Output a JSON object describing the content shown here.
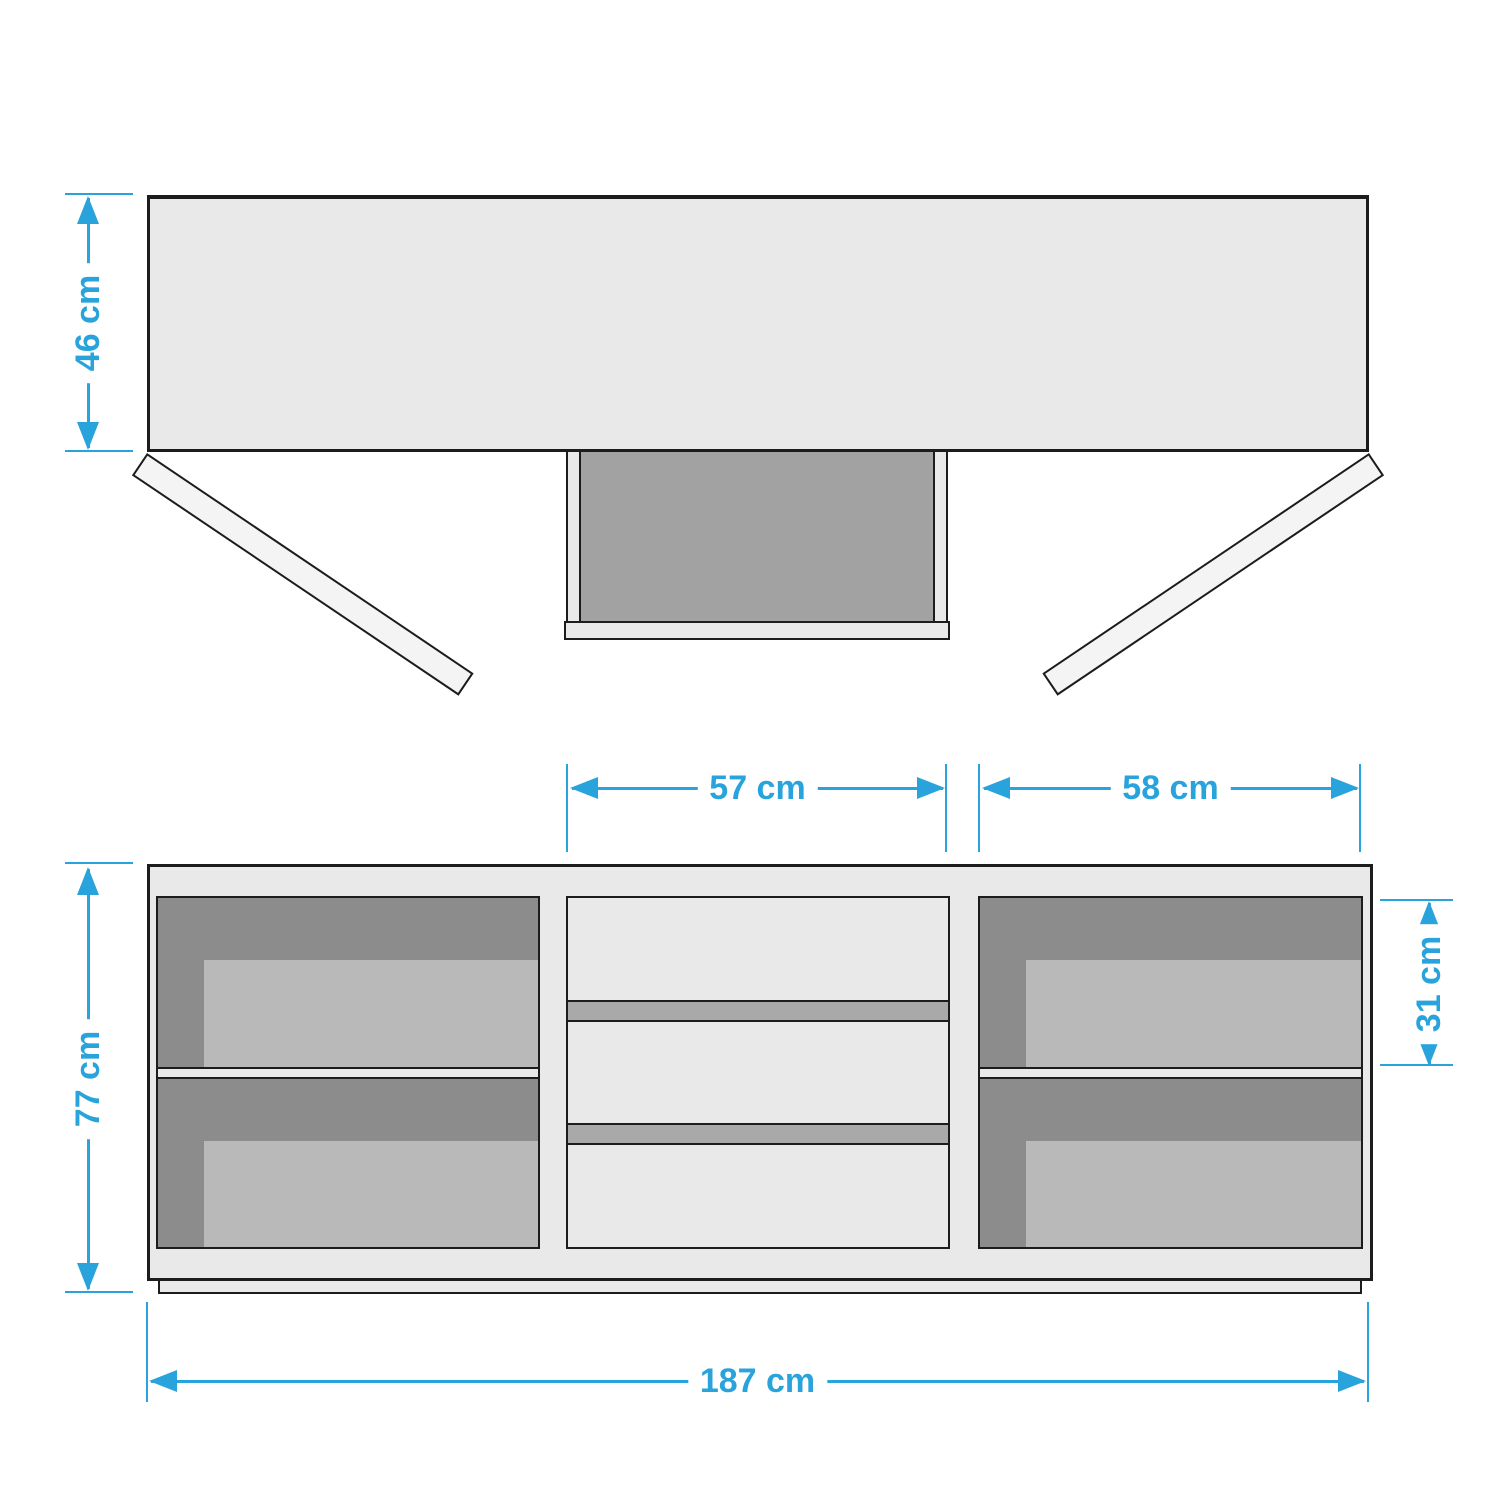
{
  "colors": {
    "dim": "#29A3DB",
    "outline": "#1C1C1C",
    "panel": "#E9E9E9",
    "panel-light": "#F4F4F4",
    "interior-dark": "#8C8C8C",
    "interior-mid": "#A2A2A2",
    "interior-light": "#B9B9B9",
    "band": "#A9A9A9",
    "background": "#FFFFFF"
  },
  "top_view": {
    "depth": {
      "label": "46 cm",
      "value_cm": 46,
      "unit": "cm"
    }
  },
  "front_view": {
    "overall_width": {
      "label": "187 cm",
      "value_cm": 187,
      "unit": "cm"
    },
    "overall_height": {
      "label": "77 cm",
      "value_cm": 77,
      "unit": "cm"
    },
    "drawer_section_width": {
      "label": "57 cm",
      "value_cm": 57,
      "unit": "cm"
    },
    "right_section_width": {
      "label": "58 cm",
      "value_cm": 58,
      "unit": "cm"
    },
    "upper_compartment_height": {
      "label": "31 cm",
      "value_cm": 31,
      "unit": "cm"
    }
  }
}
